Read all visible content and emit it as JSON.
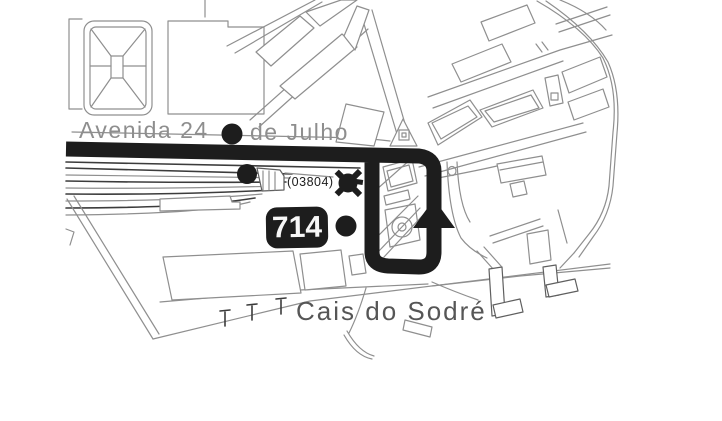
{
  "map": {
    "area_label": "Cais do Sodré",
    "street_label": {
      "part1": "Avenida 24",
      "part2": "de Julho"
    },
    "route_badge": "714",
    "stop_code": "(03804)",
    "markers": {
      "bus_stop_count": 3,
      "terminus_marker": "star",
      "direction_arrow": "up"
    },
    "colors": {
      "background": "#ffffff",
      "route_black": "#1d1d1d",
      "map_line_gray": "#8f8f8f",
      "map_line_dark": "#3c3c3c",
      "street_text_gray": "#8e8e8e",
      "area_text_gray": "#565656",
      "stop_code_black": "#1b1b1b",
      "badge_text_white": "#f7f7f7"
    }
  }
}
